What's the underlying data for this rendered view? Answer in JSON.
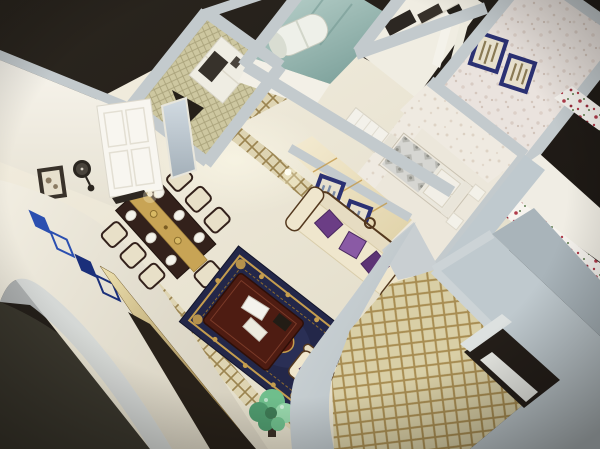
{
  "meta": {
    "title": "3D cutaway dollhouse rendering of a furnished apartment",
    "description": "Bird's-eye isometric render: dining set with gold runner, classical cream sofa with purple cushions, navy-and-gold rug with maroon coffee table, quilted-wallpaper foyer, teal glass bathroom with water heater, two wallpapered bedrooms with navy picture frames, gold lattice balcony floor, blue glass wall art and gold inlay on the cut-away wall, all on a dark backdrop."
  },
  "palette": {
    "bg_dark": "#29241d",
    "bg_dark2": "#191511",
    "bg_olive": "#3b382e",
    "cap": "#c3cacd",
    "cap_deep": "#9aa4a9",
    "wall_white": "#f5f2e9",
    "wall_shade": "#e4decd",
    "white_soft": "#f3f0e7",
    "floor_light": "#f2edde",
    "floor_dark": "#e0dac6",
    "band_light": "#f1ede1",
    "band_dark": "#d8d2c1",
    "quilt_base": "#cdc7a0",
    "quilt_line": "#aaa37b",
    "teal_light": "#c3d9d3",
    "teal_dark": "#7fa39d",
    "tile_base": "#edebe3",
    "tile_line": "#cfccc2",
    "speckle_base": "#eae3de",
    "speckle_dot": "#d7cac1",
    "speckle2_base": "#efeae1",
    "speckle2_dot": "#ded3c5",
    "lattice_base": "#ded4b2",
    "lattice_line": "#9b8450",
    "lat2_base": "#d9cfa6",
    "lat2_line": "#a88d52",
    "accent_light": "#f2e9cf",
    "accent_dark": "#e2d4ab",
    "accent_gold": "#c49a4a",
    "frame_navy": "#2b3173",
    "art_beige": "#e7e0cd",
    "art_streak": "#7a8aa5",
    "art_tan": "#8a7a55",
    "sofa_cream": "#efe6cd",
    "sofa_shade": "#e6dcc2",
    "sofa_trim": "#54391f",
    "cushion_a": "#6b3d85",
    "cushion_b": "#8a5aa5",
    "cushion_c": "#5d3375",
    "rug_navy": "#232749",
    "rug_field": "#2c3157",
    "rug_gold": "#c59d4e",
    "rug_gold_dark": "#8d6b2f",
    "rug_red": "#5c1e14",
    "table_maroon": "#4e1c12",
    "table_edge": "#2e0f08",
    "wood_dark": "#33211b",
    "runner_gold": "#c8a455",
    "plate": "#f4f2ea",
    "chair_cream": "#e8e0c8",
    "plant": "#6fbe8c",
    "plant_deep": "#4f9a6e",
    "plant_light": "#98d8ac",
    "plant_core": "#3e7a55",
    "pot": "#3a2f26",
    "heater": "#eef0e9",
    "heater_shade": "#d9ddd2",
    "door_white": "#f8f6f0",
    "door_line": "#e3dfd3",
    "opening_dark": "#241e19",
    "door_slab": "#e9eae5",
    "mirror_light": "#cdd6dd",
    "mirror_dark": "#aab6bf",
    "bed_silver": "#d6d6d2",
    "bed_motif": "#ababa4",
    "bed_sheet": "#eae7dd",
    "pillow": "#f2efe7",
    "floral_base": "#f7f4ef",
    "floral_red": "#b03b4a",
    "floral_green": "#5a7a4a",
    "tv_dark": "#282119",
    "blade_light": "#ecdfae",
    "blade_dark": "#8a6f3a",
    "glass_blue": "#2b4fb0",
    "glass_navy": "#1a2f7a",
    "cabinet_dark": "#37322b",
    "gray_zone_light": "#bfc9ce",
    "gray_zone_dark": "#a9b4ba"
  },
  "scene": {
    "view": "isometric dollhouse cutaway, rotated ~38 degrees on dark background",
    "rooms": [
      "dining-room",
      "living-room",
      "hallway",
      "foyer",
      "bathroom",
      "kitchen",
      "master-bedroom",
      "second-bedroom",
      "balcony"
    ],
    "furniture": [
      "dining-table-with-gold-runner",
      "six-white-plates",
      "gold-candelabra",
      "dining-chairs",
      "classical-sofa",
      "purple-cushions",
      "armchair",
      "navy-gold-rug",
      "maroon-coffee-table",
      "white-books",
      "green-plant",
      "bed-with-silver-bedding",
      "white-nightstands",
      "wardrobe",
      "foyer-cabinet",
      "water-heater",
      "white-paneled-door",
      "standing-mirror",
      "wall-clock",
      "framed-pictures"
    ],
    "decor": [
      "blue-glass-diamond-wall-art",
      "gold-inlay-blade",
      "wall-mounted-tv-band",
      "diamond-quilt-wallpaper",
      "floral-border-wallpaper",
      "gold-lattice-floor-tiles",
      "marble-floor-with-lattice-inlay"
    ]
  }
}
